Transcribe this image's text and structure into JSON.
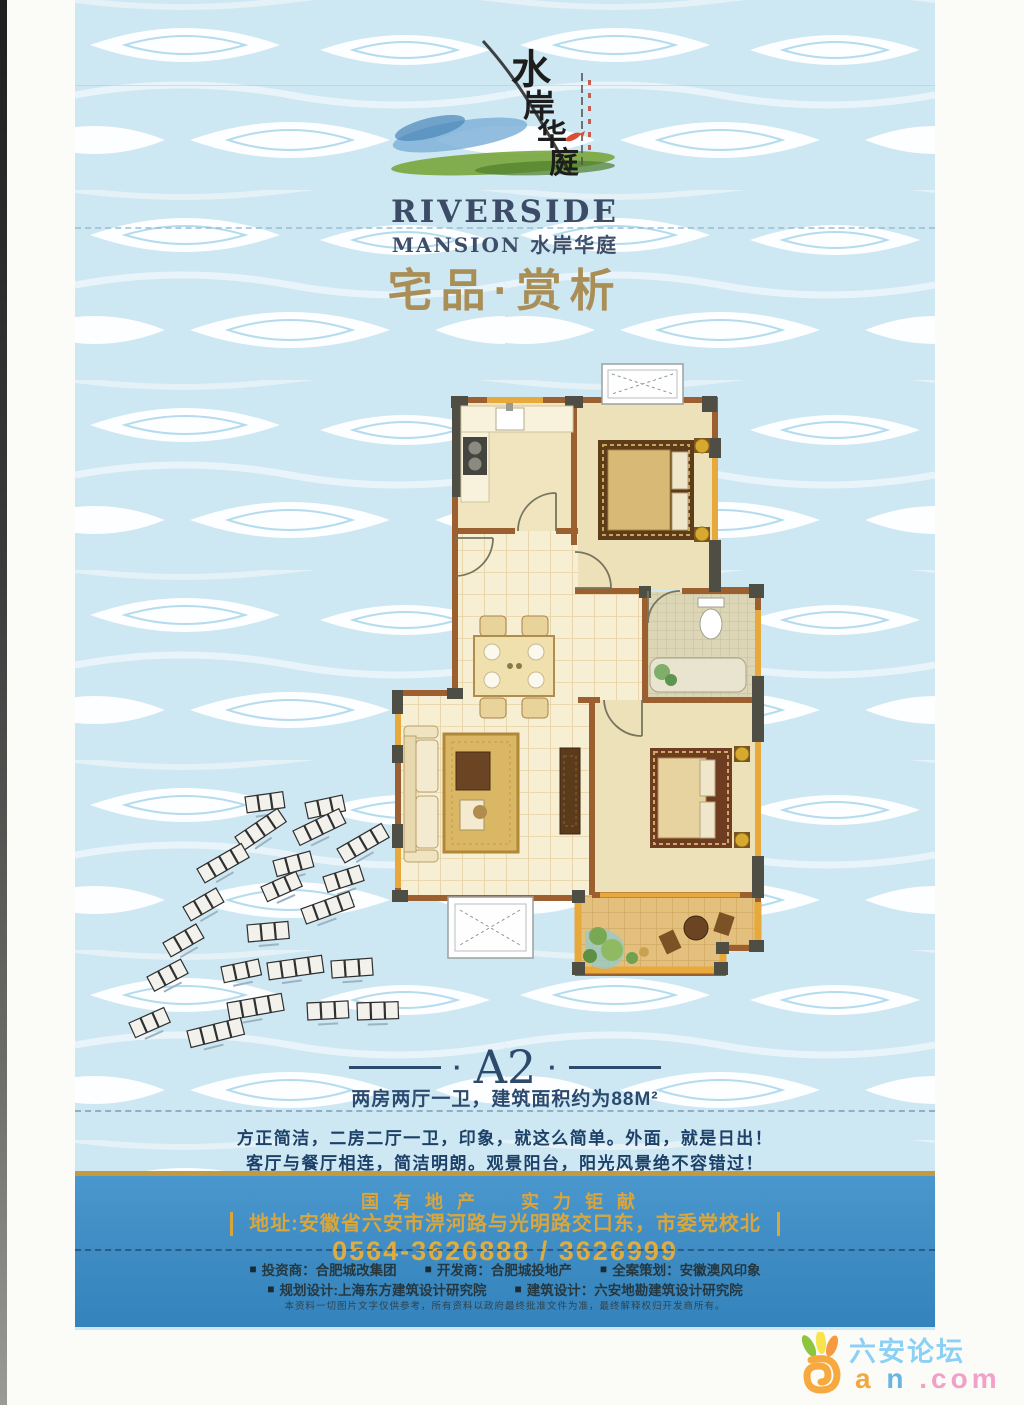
{
  "brand": {
    "calligraphy_chars": [
      "水",
      "岸",
      "华",
      "庭"
    ],
    "name_en": "RIVERSIDE",
    "name_cn": "MANSION 水岸华庭",
    "section_title": "宅品·赏析"
  },
  "unit": {
    "label": "A2",
    "dot": "·",
    "spec": "两房两厅一卫，建筑面积约为88M²",
    "slogan1": "方正简洁，二房二厅一卫，印象，就这么简单。外面，就是日出！",
    "slogan2": "客厅与餐厅相连，简洁明朗。观景阳台，阳光风景绝不容错过！"
  },
  "footer": {
    "headline": "国有地产　实力钜献",
    "address": "地址:安徽省六安市淠河路与光明路交口东，市委党校北",
    "phone": "0564-3626888 / 3626999",
    "bullet": "■",
    "credits1": [
      "投资商：合肥城改集团",
      "开发商：合肥城投地产",
      "全案策划：安徽澳风印象"
    ],
    "credits2": [
      "规划设计:上海东方建筑设计研究院",
      "建筑设计：六安地勘建筑设计研究院"
    ],
    "disclaimer": "本资料一切图片文字仅供参考，所有资料以政府最终批准文件为准，最终解释权归开发商所有。"
  },
  "watermark": {
    "site": "六安论坛",
    "domain_a": "a",
    "domain_n": "n",
    "domain_rest": ".com"
  },
  "colors": {
    "band_blue": "#3d8bc2",
    "accent_gold": "#c49a3e",
    "title_navy": "#2c4a6b",
    "section_gold": "#a98e56",
    "wall_brown": "#9c6030",
    "window_orange": "#e7a83c"
  }
}
